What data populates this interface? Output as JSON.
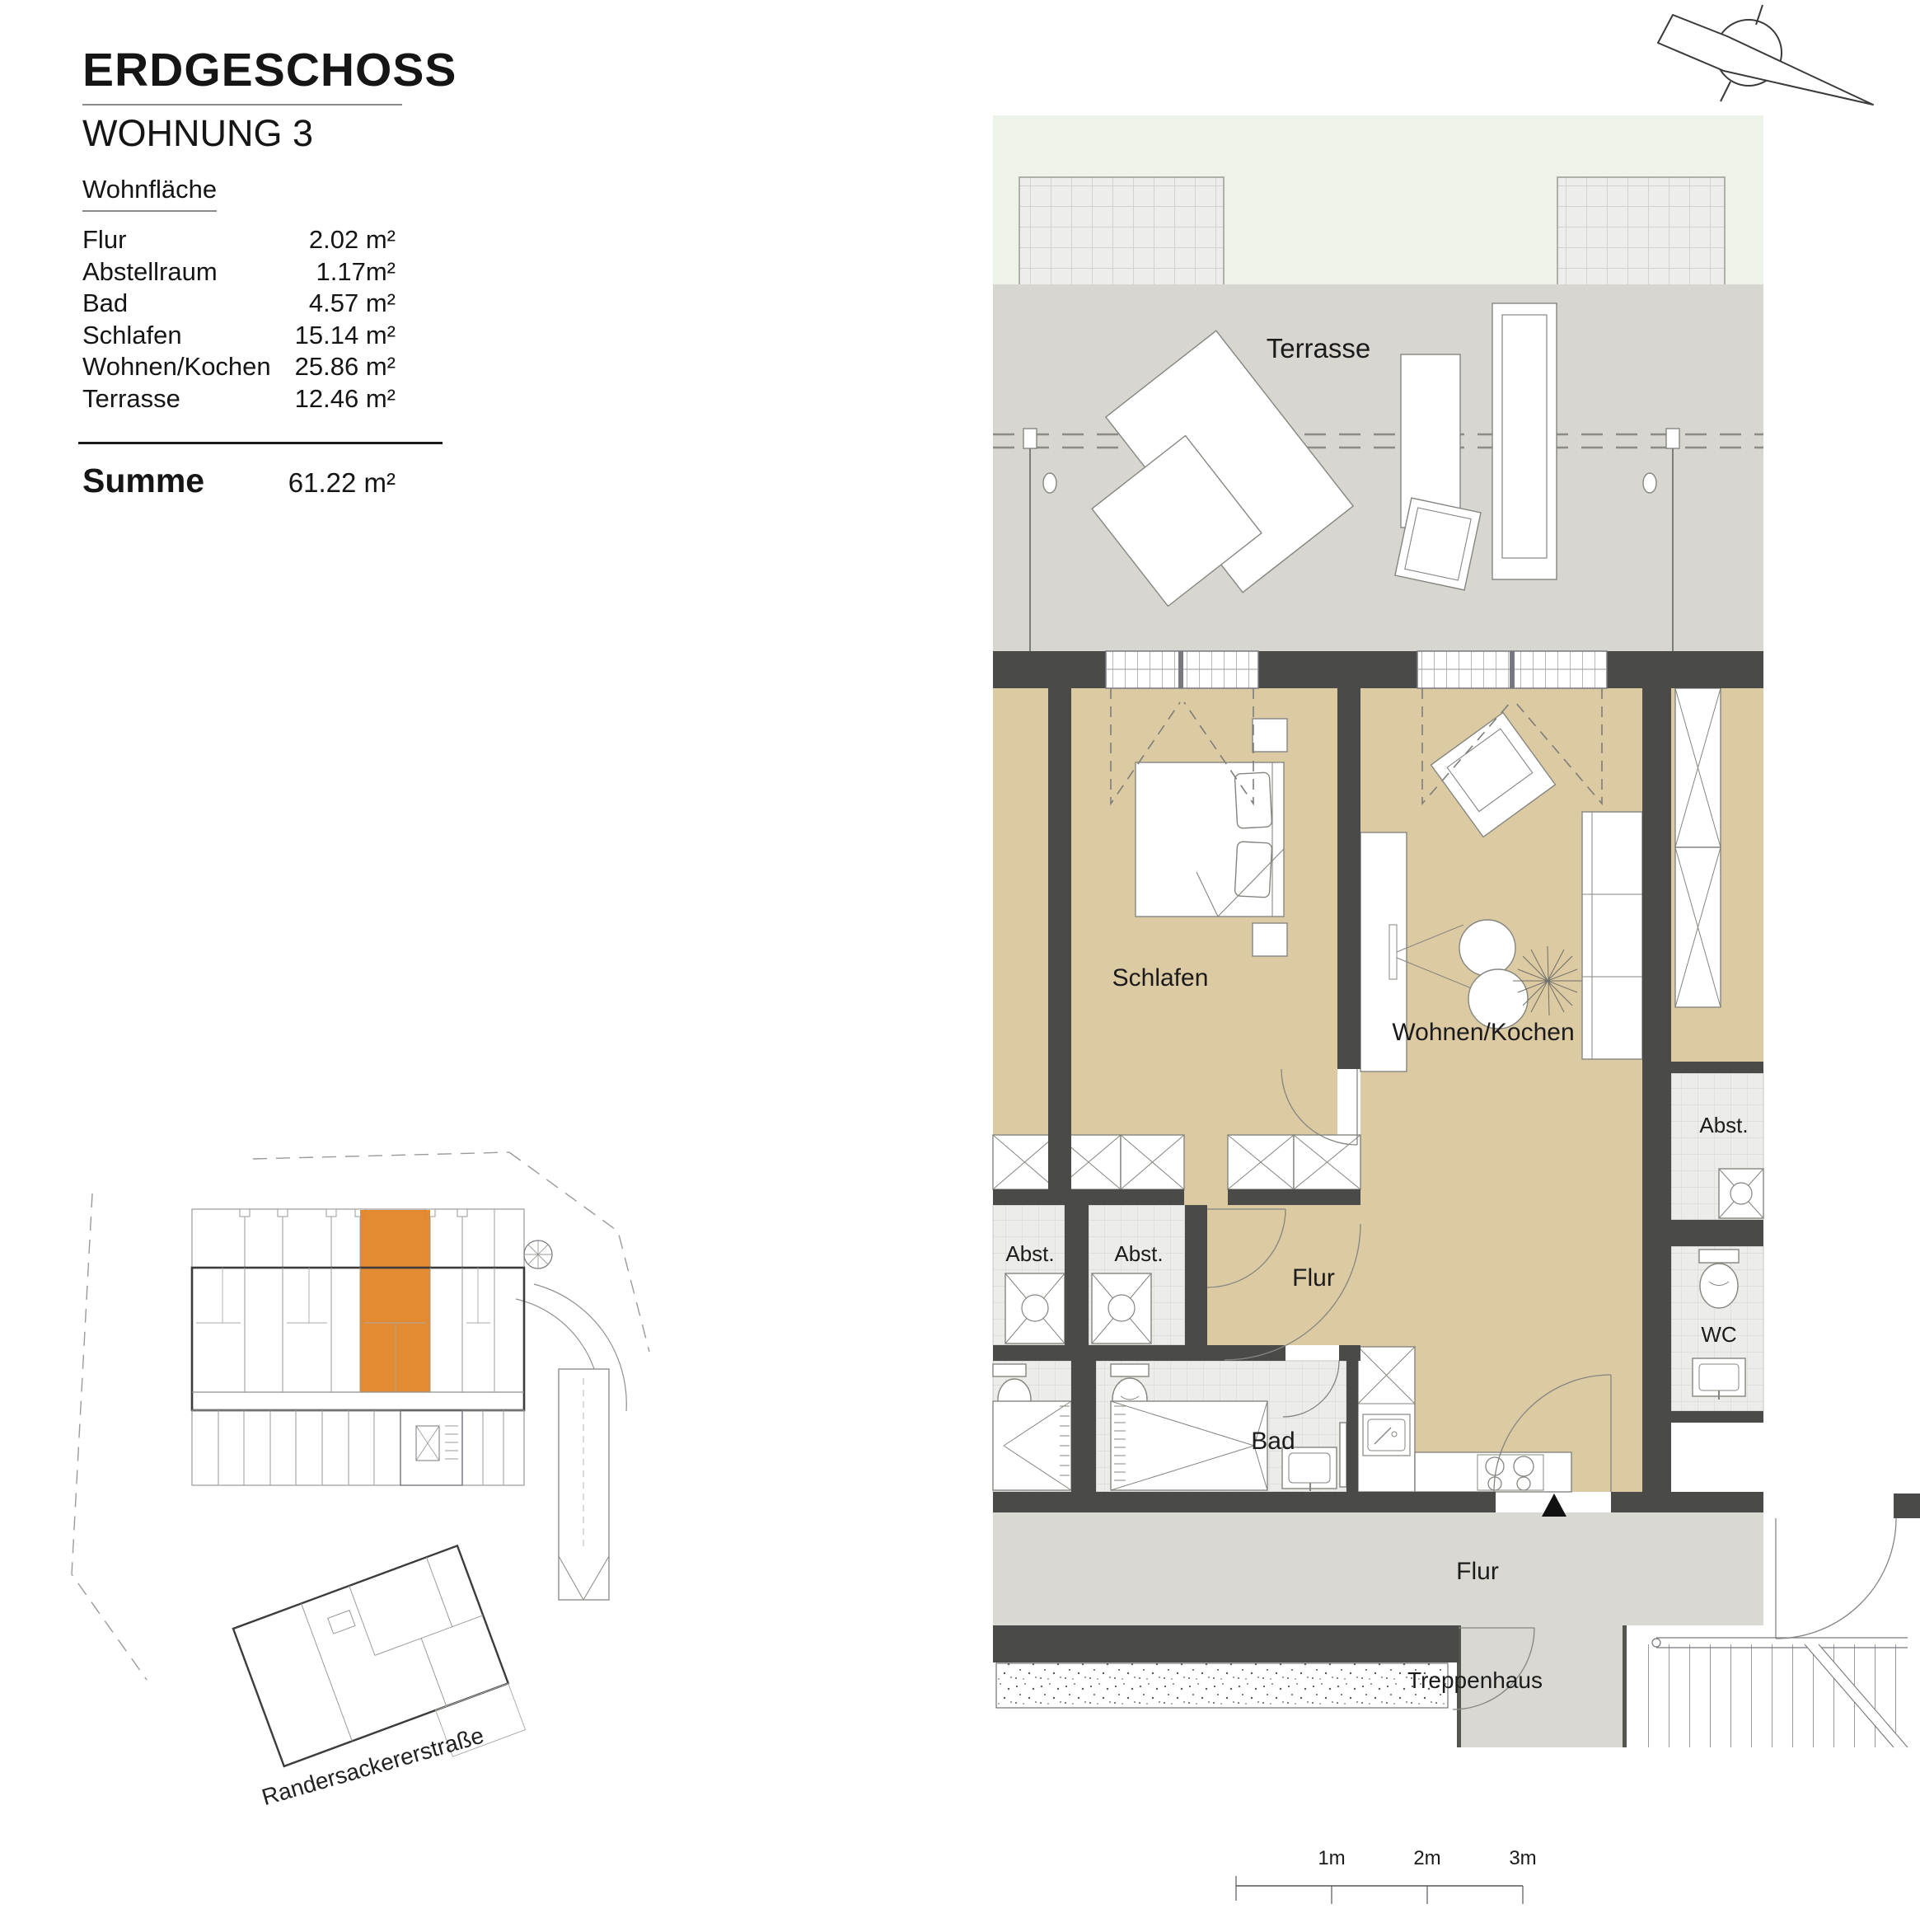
{
  "header": {
    "title": "ERDGESCHOSS",
    "subtitle": "WOHNUNG 3"
  },
  "area_table": {
    "heading": "Wohnfläche",
    "rows": [
      {
        "label": "Flur",
        "value": "2.02 m²"
      },
      {
        "label": "Abstellraum",
        "value": "1.17m²"
      },
      {
        "label": "Bad",
        "value": "4.57 m²"
      },
      {
        "label": "Schlafen",
        "value": "15.14 m²"
      },
      {
        "label": "Wohnen/Kochen",
        "value": "25.86 m²"
      },
      {
        "label": "Terrasse",
        "value": "12.46 m²"
      }
    ],
    "sum": {
      "label": "Summe",
      "value": "61.22 m²"
    }
  },
  "site_plan": {
    "street_label": "Randersackererstraße",
    "highlight_color": "#e08527"
  },
  "floor_plan": {
    "room_labels": {
      "terrasse": "Terrasse",
      "schlafen": "Schlafen",
      "wohnen_kochen": "Wohnen/Kochen",
      "abst_left": "Abst.",
      "abst_mid": "Abst.",
      "abst_right": "Abst.",
      "wc": "WC",
      "flur_apartment": "Flur",
      "bad": "Bad",
      "flur_common": "Flur",
      "treppenhaus": "Treppenhaus"
    },
    "scale_bar": {
      "labels": [
        "1m",
        "2m",
        "3m"
      ]
    },
    "colors": {
      "wall": "#4a4a48",
      "floor_tan": "#dccaa3",
      "terrace_gray": "#d8d6d1",
      "garden_green": "#edf3e9",
      "common_gray": "#d9d8d2"
    }
  }
}
